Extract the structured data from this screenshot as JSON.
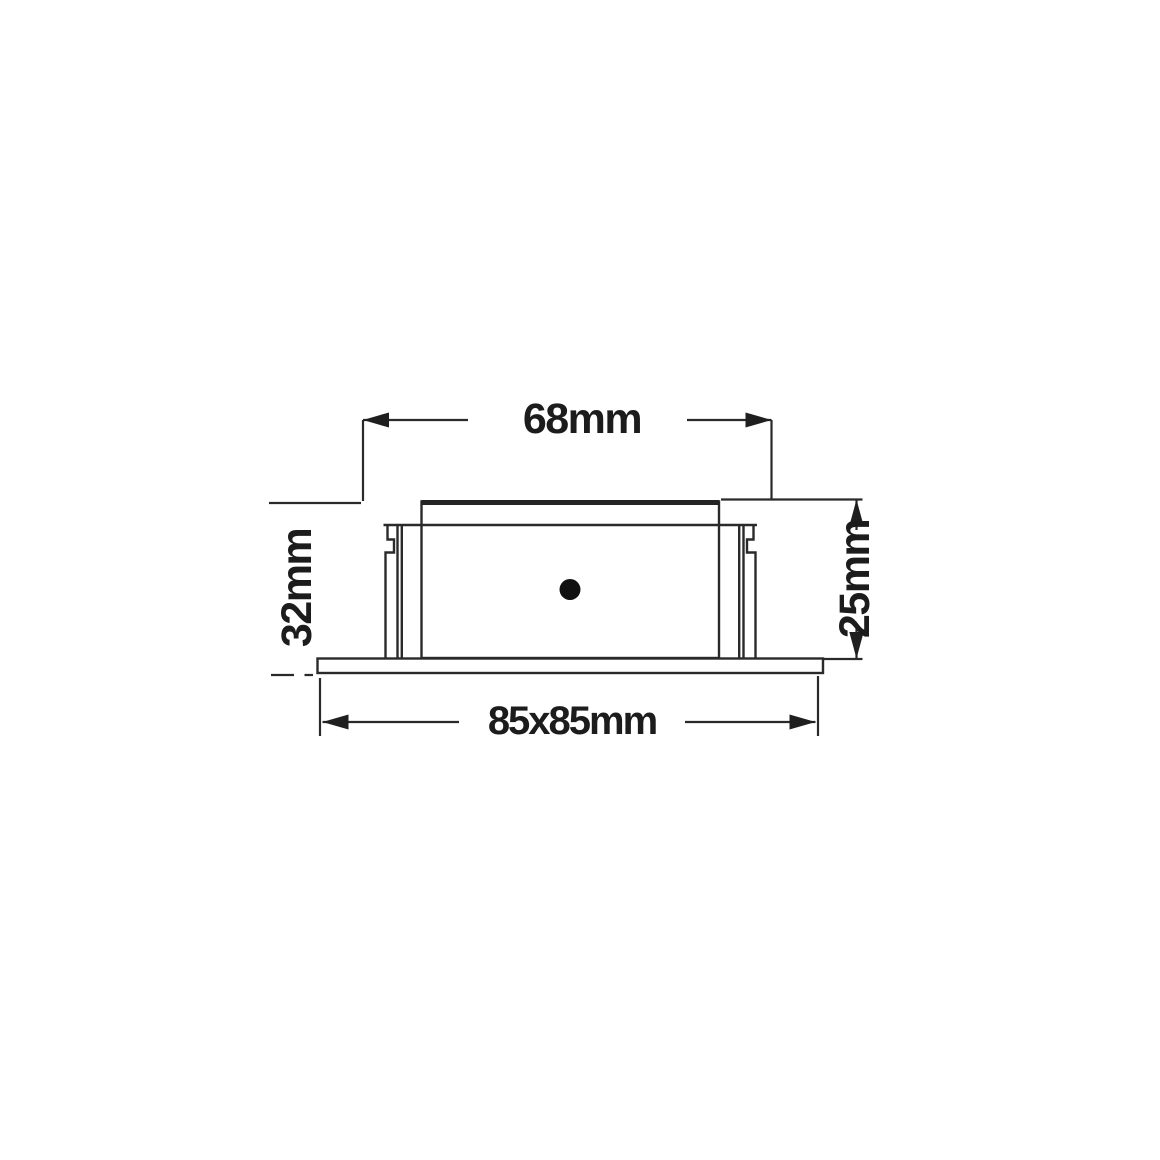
{
  "page": {
    "type": "technical dimension drawing",
    "background_color": "#ffffff",
    "line_color": "#2a2a2a",
    "text_color": "#1c1c1c"
  },
  "drawing": {
    "subject": "recessed-square-downlight-side-view",
    "features": [
      "face-bezel",
      "lamp-body",
      "mounting-clip-left",
      "mounting-clip-right",
      "center-dot",
      "base-flange"
    ],
    "dimensions": {
      "top_width": {
        "label": "68mm",
        "orientation": "horizontal",
        "measures": "cut-out width"
      },
      "left_height": {
        "label": "32mm",
        "orientation": "vertical",
        "measures": "overall height"
      },
      "right_depth": {
        "label": "25mm",
        "orientation": "vertical",
        "measures": "recess depth"
      },
      "bottom_width": {
        "label": "85x85mm",
        "orientation": "horizontal",
        "measures": "face plate size"
      }
    }
  }
}
